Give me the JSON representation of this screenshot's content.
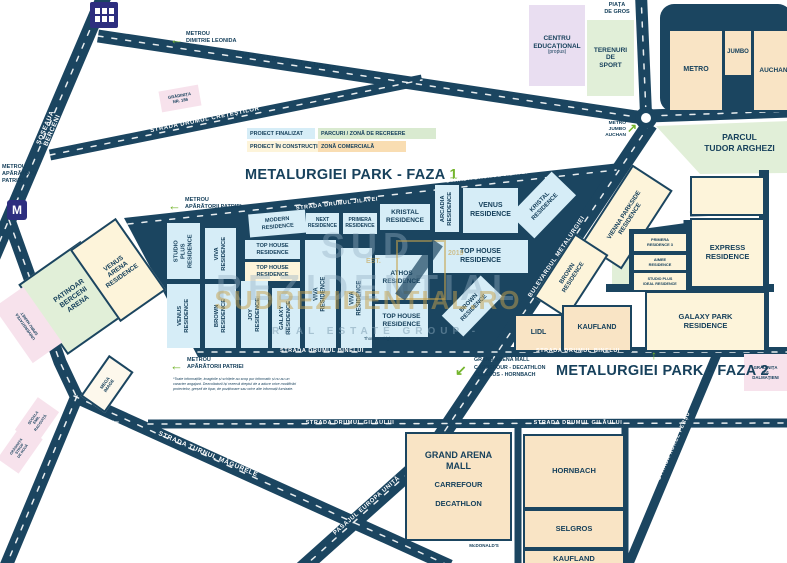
{
  "legend": {
    "finalizat": "PROIECT FINALIZAT",
    "constructie": "PROIECT ÎN CONSTRUCȚIE",
    "parcuri": "PARCURI / ZONĂ DE RECREERE",
    "comerciala": "ZONĂ COMERCIALĂ"
  },
  "titles": {
    "faza1": "METALURGIEI PARK - FAZA",
    "faza1_nr": "1",
    "faza2": "METALURGIEI PARK - FAZA",
    "faza2_nr": "2",
    "arrow_up": "↑"
  },
  "streets": {
    "berceni": "ȘOSEAUA BERCENI",
    "cretestilor": "STRADA DRUMUL CREȚEȘTILOR",
    "metalurgiei": "BULEVARDUL METALURGIEI",
    "jilavei": "STRADA DRUMUL JILAVEI",
    "binelui": "STRADA DRUMUL BINELUI",
    "gilaului": "STRADA DRUMUL GILĂULUI",
    "racovita": "STRADA EMIL RACOVIȚĂ",
    "turnul": "STRADA TURNUL MĂGURELE",
    "pasajul": "PASAJUL EUROPA UNITĂ",
    "aurel": "STRADA AUREL PERȘU"
  },
  "metro": {
    "leonida": "METROU\nDIMITRIE LEONIDA",
    "aparatorii3": "METROU\nAPĂRĂTORII\nPATRIEI",
    "aparatorii2": "METROU\nAPĂRĂTORII PATRIEI",
    "m": "M",
    "arrow_left": "←",
    "jumbo_auchan": "METRO\nJUMBO\nAUCHAN",
    "arrow_ne": "↗"
  },
  "blocks": {
    "modern": "MODERN\nRESIDENCE",
    "next": "NEXT\nRESIDENCE",
    "primera": "PRIMERA\nRESIDENCE",
    "kristal": "KRISTAL\nRESIDENCE",
    "arcadia": "ARCADIA\nRESIDENCE",
    "venus": "VENUS\nRESIDENCE",
    "tophouse": "TOP HOUSE\nRESIDENCE",
    "studio_plus": "STUDIO PLUS\nRESIDENCE",
    "viva": "VIVA\nRESIDENCE",
    "brown": "BROWN\nRESIDENCE",
    "joy": "JOY\nRESIDENCE",
    "galaxy": "GALAXY\nRESIDENCE",
    "athos": "ATHOS\nRESIDENCE",
    "vienna": "VIENNA PARKSIDE\nRESIDENCE",
    "express": "EXPRESS\nRESIDENCE",
    "galaxy_park": "GALAXY PARK\nRESIDENCE",
    "primera3": "PRIMERA\nRESIDENCE 3",
    "aimee": "AIMEE\nRESIDENCE",
    "sp_ideal": "STUDIO PLUS\nIDEAL RESIDENCE"
  },
  "stores": {
    "metro": "METRO",
    "jumbo": "JUMBO",
    "auchan": "AUCHAN",
    "lidl": "LIDL",
    "kaufland": "KAUFLAND",
    "hornbach": "HORNBACH",
    "selgros": "SELGROS",
    "kaufland2": "KAUFLAND",
    "mall_title": "GRAND ARENA\nMALL",
    "carrefour": "CARREFOUR",
    "decathlon": "DECATHLON",
    "mcdonalds": "McDONALD'S"
  },
  "places": {
    "piata": "PIAȚA\nDE GROS",
    "centru": "CENTRU\nEDUCAȚIONAL",
    "centru_sub": "(propus)",
    "terenuri": "TERENURI\nDE\nSPORT",
    "parcul": "PARCUL\nTUDOR ARGHEZI",
    "patinoar": "PATINOAR\nBERCENI\nARENA",
    "venus_arena": "VENUS\nARENA\nRESIDENCE",
    "universitatea": "UNIVERSITATEA\nSPIRU HARET",
    "mega": "MEGA\nIMAGE",
    "scoala": "ȘCOALA\nEMIL\nRACOVIȚĂ",
    "gradinita_strop": "GRĂDINIȚA\nSTROP\nDE ROUĂ",
    "gradinita_186": "GRĂDINIȚA\nNR. 186",
    "gradinita_101": "GRĂDINIȚA\n101\nDALMAȚIENI",
    "thomas": "Thomas Midgley Jr.",
    "grand_arena_poi": "GRAND ARENA MALL\nCARREFOUR - DECATHLON\nSELGROS - HORNBACH",
    "arrow_sw": "↙"
  },
  "watermark": {
    "line1": "SUD REZIDENTIAL",
    "line2": "SUDREZIDENTIAL.RO",
    "line3": "- REAL ESTATE GROUP -",
    "est": "EST.",
    "year": "2019"
  },
  "disclaimer": "*Toate informațiile, imaginile și schițele au scop pur informativ și nu au un caracter angajant. Dezvoltatorii își rezervă dreptul de a aduce orice modificări proiectelor, greșeli de tipar, de poziționare sau orice alte informații furnizate."
}
